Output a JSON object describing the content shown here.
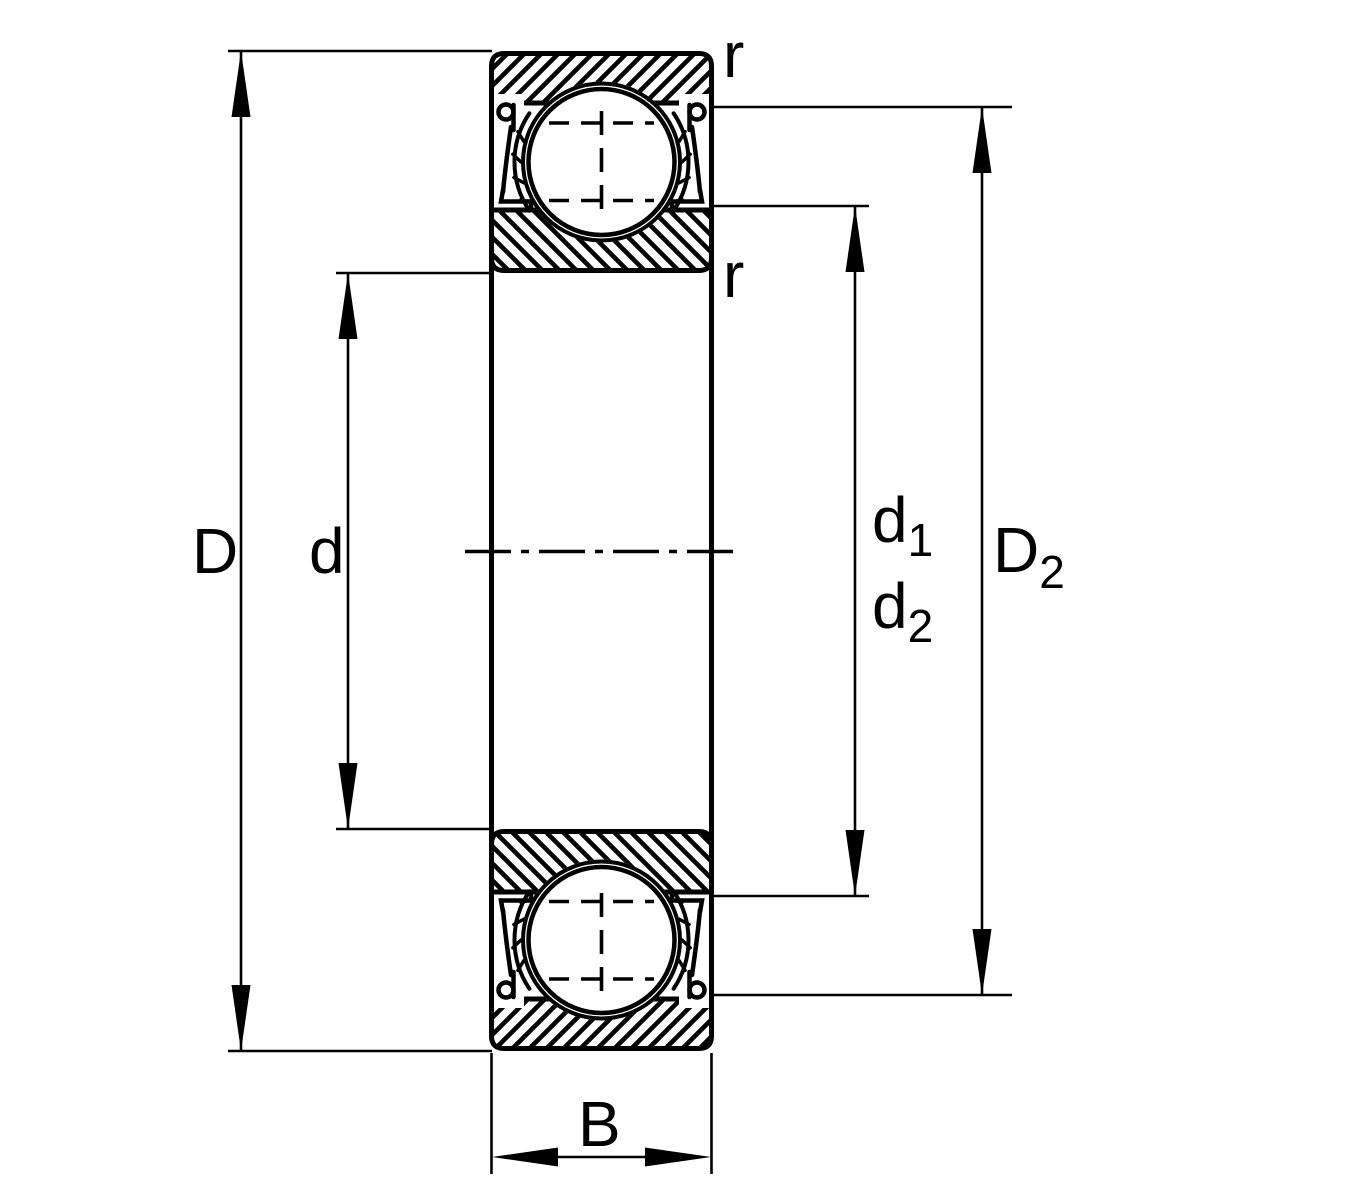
{
  "diagram": {
    "kind": "bearing cross-section dimension drawing",
    "colors": {
      "line": "#000000",
      "background": "#ffffff"
    },
    "labels": {
      "outer_diameter": "D",
      "bore_diameter": "d",
      "d1": {
        "base": "d",
        "sub": "1"
      },
      "d2": {
        "base": "d",
        "sub": "2"
      },
      "D2": {
        "base": "D",
        "sub": "2"
      },
      "width": "B",
      "chamfer_top": "r",
      "chamfer_bottom": "r"
    }
  }
}
